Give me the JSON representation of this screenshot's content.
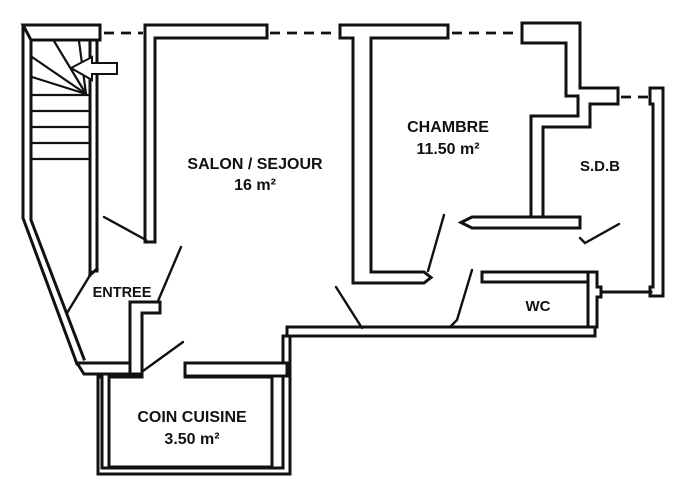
{
  "colors": {
    "ink": "#111111",
    "background": "#ffffff"
  },
  "rooms": {
    "salon": {
      "name": "SALON / SEJOUR",
      "area": "16 m²"
    },
    "chambre": {
      "name": "CHAMBRE",
      "area": "11.50 m²"
    },
    "sdb": {
      "name": "S.D.B"
    },
    "entree": {
      "name": "ENTREE"
    },
    "wc": {
      "name": "WC"
    },
    "cuisine": {
      "name": "COIN CUISINE",
      "area": "3.50 m²"
    }
  }
}
